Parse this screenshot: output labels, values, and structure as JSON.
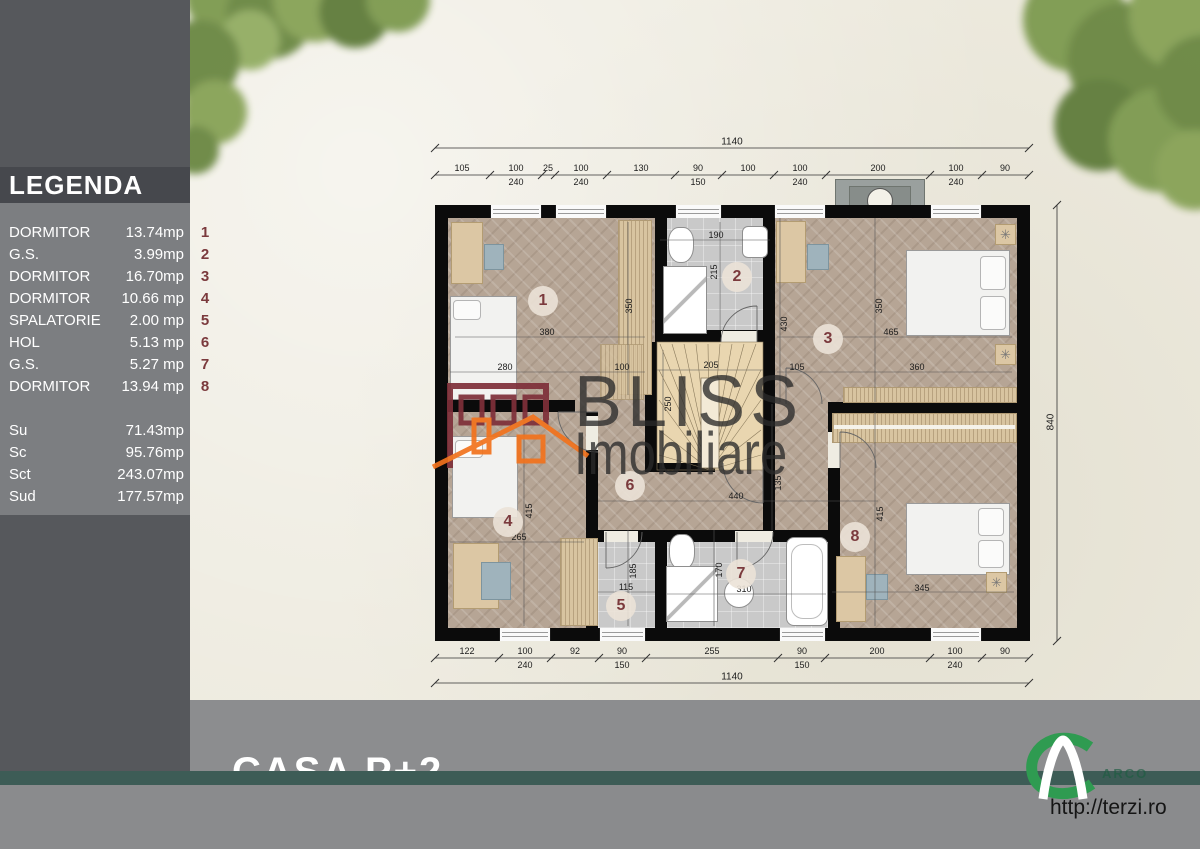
{
  "legend": {
    "title": "LEGENDA",
    "rows": [
      {
        "name": "DORMITOR",
        "value": "13.74mp",
        "num": "1"
      },
      {
        "name": "G.S.",
        "value": "3.99mp",
        "num": "2"
      },
      {
        "name": "DORMITOR",
        "value": "16.70mp",
        "num": "3"
      },
      {
        "name": "DORMITOR",
        "value": "10.66 mp",
        "num": "4"
      },
      {
        "name": "SPALATORIE",
        "value": "2.00 mp",
        "num": "5"
      },
      {
        "name": "HOL",
        "value": "5.13 mp",
        "num": "6"
      },
      {
        "name": "G.S.",
        "value": "5.27 mp",
        "num": "7"
      },
      {
        "name": "DORMITOR",
        "value": "13.94 mp",
        "num": "8"
      }
    ],
    "totals": [
      {
        "name": "Su",
        "value": "71.43mp"
      },
      {
        "name": "Sc",
        "value": "95.76mp"
      },
      {
        "name": "Sct",
        "value": "243.07mp"
      },
      {
        "name": "Sud",
        "value": "177.57mp"
      }
    ]
  },
  "watermark": {
    "line1": "BLISS",
    "line2": "Imobiliare"
  },
  "footer": {
    "project_title": "CASA P+2",
    "website": "http://terzi.ro",
    "logo_text": "ARCO"
  },
  "colors": {
    "accent_maroon": "#7b3a3d",
    "teal_band": "#3d5c56",
    "logo_orange": "#f2731d",
    "logo_green": "#2f9b51",
    "wall_black": "#0b0b0b"
  },
  "floorplan": {
    "overall_width_label": "1140",
    "overall_width_label_bottom": "1140",
    "overall_height_label": "840",
    "top_chain": [
      {
        "label": "105",
        "x": 462
      },
      {
        "label": "100",
        "sub": "240",
        "x": 516
      },
      {
        "label": "25",
        "x": 548
      },
      {
        "label": "100",
        "sub": "240",
        "x": 581
      },
      {
        "label": "130",
        "x": 641
      },
      {
        "label": "90",
        "sub": "150",
        "x": 698
      },
      {
        "label": "100",
        "x": 748
      },
      {
        "label": "100",
        "sub": "240",
        "x": 800
      },
      {
        "label": "200",
        "x": 878
      },
      {
        "label": "100",
        "sub": "240",
        "x": 956
      },
      {
        "label": "90",
        "x": 1005
      }
    ],
    "bottom_chain": [
      {
        "label": "122",
        "x": 467
      },
      {
        "label": "100",
        "sub": "240",
        "x": 525
      },
      {
        "label": "92",
        "x": 575
      },
      {
        "label": "90",
        "sub": "150",
        "x": 622
      },
      {
        "label": "255",
        "x": 712
      },
      {
        "label": "90",
        "sub": "150",
        "x": 802
      },
      {
        "label": "200",
        "x": 877
      },
      {
        "label": "100",
        "sub": "240",
        "x": 955
      },
      {
        "label": "90",
        "x": 1005
      }
    ],
    "room_badges": [
      {
        "num": "1",
        "x": 543,
        "y": 301
      },
      {
        "num": "2",
        "x": 737,
        "y": 277
      },
      {
        "num": "3",
        "x": 828,
        "y": 339
      },
      {
        "num": "4",
        "x": 508,
        "y": 522
      },
      {
        "num": "5",
        "x": 621,
        "y": 606
      },
      {
        "num": "6",
        "x": 630,
        "y": 486
      },
      {
        "num": "7",
        "x": 741,
        "y": 574
      },
      {
        "num": "8",
        "x": 855,
        "y": 537
      }
    ],
    "dims": [
      {
        "t": "380",
        "x": 547,
        "y": 332
      },
      {
        "t": "280",
        "x": 505,
        "y": 367
      },
      {
        "t": "100",
        "x": 622,
        "y": 367
      },
      {
        "t": "350",
        "x": 629,
        "y": 306,
        "rot": 1
      },
      {
        "t": "190",
        "x": 716,
        "y": 235
      },
      {
        "t": "215",
        "x": 714,
        "y": 272,
        "rot": 1
      },
      {
        "t": "205",
        "x": 711,
        "y": 365
      },
      {
        "t": "250",
        "x": 668,
        "y": 404,
        "rot": 1
      },
      {
        "t": "430",
        "x": 784,
        "y": 324,
        "rot": 1
      },
      {
        "t": "350",
        "x": 879,
        "y": 306,
        "rot": 1
      },
      {
        "t": "465",
        "x": 891,
        "y": 332
      },
      {
        "t": "105",
        "x": 797,
        "y": 367
      },
      {
        "t": "360",
        "x": 917,
        "y": 367
      },
      {
        "t": "440",
        "x": 736,
        "y": 496
      },
      {
        "t": "135",
        "x": 778,
        "y": 483,
        "rot": 1
      },
      {
        "t": "415",
        "x": 529,
        "y": 511,
        "rot": 1
      },
      {
        "t": "265",
        "x": 519,
        "y": 537
      },
      {
        "t": "115",
        "x": 626,
        "y": 587
      },
      {
        "t": "185",
        "x": 633,
        "y": 571,
        "rot": 1
      },
      {
        "t": "170",
        "x": 719,
        "y": 570,
        "rot": 1
      },
      {
        "t": "310",
        "x": 744,
        "y": 589
      },
      {
        "t": "345",
        "x": 922,
        "y": 588
      },
      {
        "t": "415",
        "x": 880,
        "y": 514,
        "rot": 1
      }
    ]
  }
}
